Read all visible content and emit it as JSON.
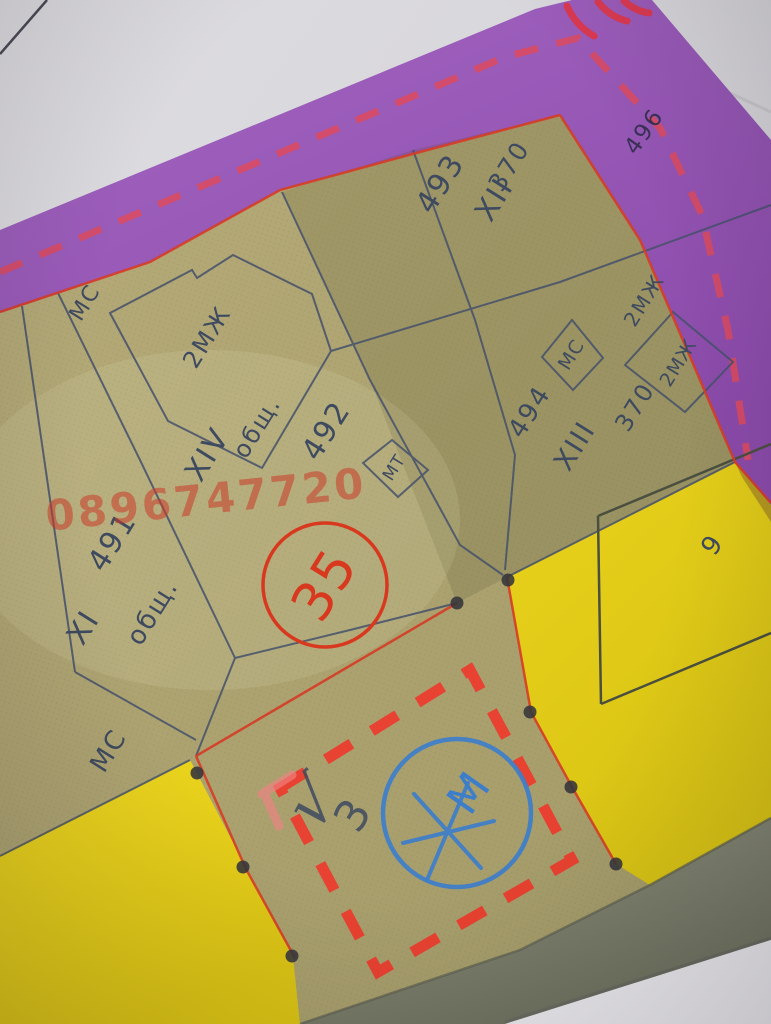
{
  "labels": {
    "ms_top_left": "МС",
    "building_2mzh": "2МЖ",
    "parcel_493": "493",
    "roman_xii": "XII",
    "quarter_370_a": "370",
    "ms_box": "МС",
    "mzh2_caption": "2МЖ",
    "mzh2_box": "2МЖ",
    "parcel_494": "494",
    "roman_xiii": "XIII",
    "quarter_370_b": "370",
    "roman_xiv": "XIV",
    "obsht_a": "общ.",
    "parcel_492": "492",
    "parcel_491": "491",
    "roman_xi": "XI",
    "obsht_b": "общ.",
    "ms_bottom": "МС",
    "mt_box": "МТ",
    "parcel_496": "496",
    "number_9": "9",
    "stamp_35": "35",
    "blue_m": "М",
    "hand_check": "√",
    "hand_3": "3"
  },
  "watermark": {
    "phone": "0896747720"
  },
  "colors": {
    "purple_band": "#9a5ab8",
    "sheet_khaki": "#b0a572",
    "street_yellow": "#e8d11b",
    "road_gray": "#8e907f",
    "marker_red": "#ee3a2c",
    "ink_blue": "#3d7ecb",
    "line_red": "#d63c25",
    "map_ink": "#3e4a5f",
    "background_paper": "#d7d6da"
  }
}
